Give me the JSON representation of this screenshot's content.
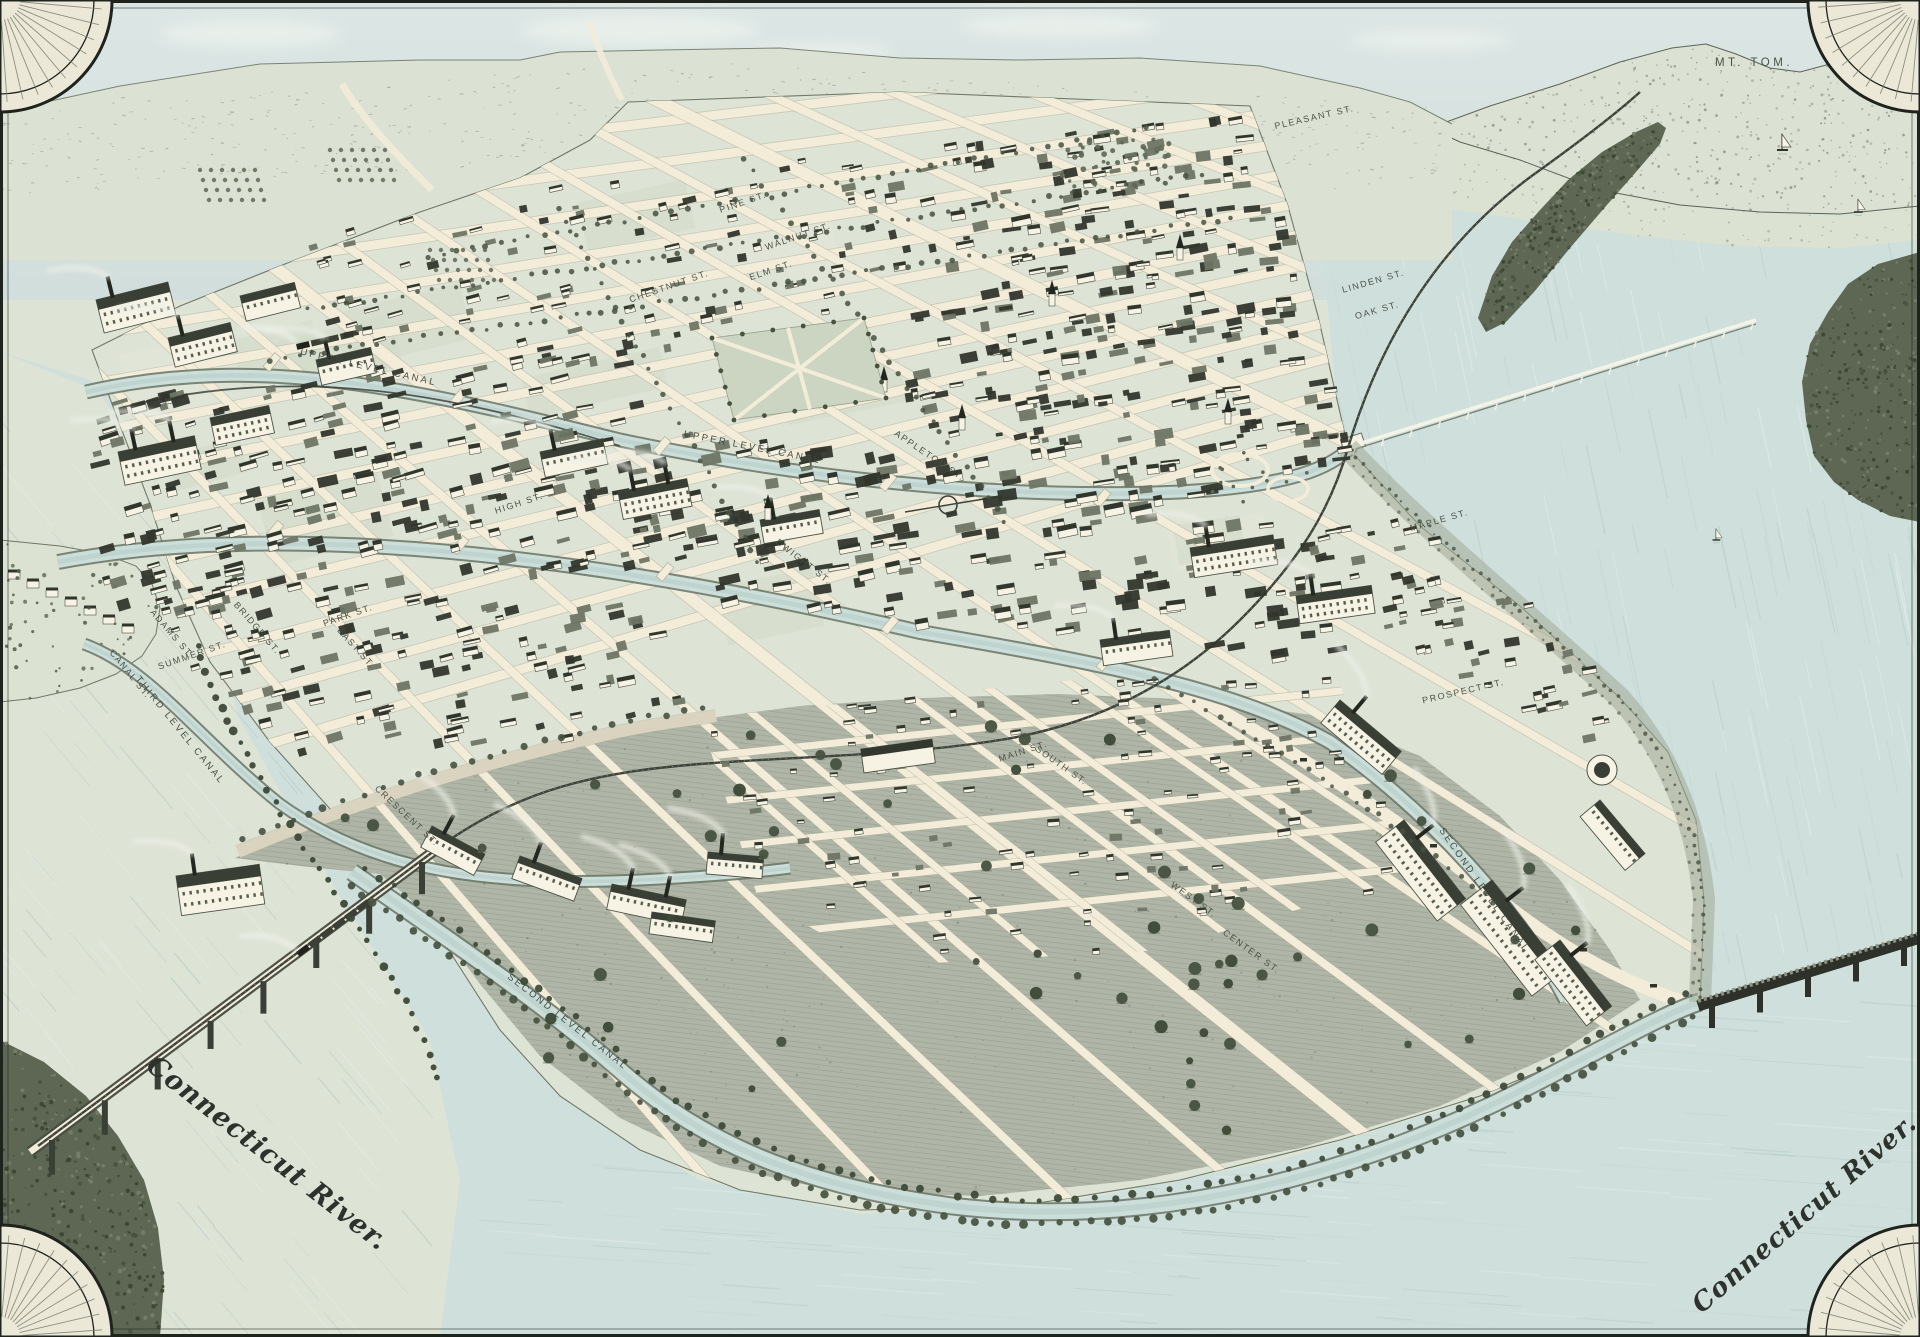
{
  "meta": {
    "title": "Bird's-eye view map of a Connecticut River mill city"
  },
  "colors": {
    "sky": "#d6e1df",
    "cloud": "#f3f6f1",
    "hills": "#dce2d3",
    "hill_texture": "#87907e",
    "fields": "#dce2d2",
    "water": "#cfdfdc",
    "water_streak": "#b4cac6",
    "water_light": "#e4eeec",
    "land": "#dde3d5",
    "block_tint_a": "#d2dac8",
    "block_tint_b": "#e3e8da",
    "meadow": "#b0b6a7",
    "meadow_texture": "#868d7d",
    "street": "#f2ecd9",
    "street_edge": "#b4af9c",
    "woods_dark": "#46513f",
    "woods_mid": "#5d6754",
    "woods_light": "#76806a",
    "canal_water": "#cbdeda",
    "canal_edge": "#6f7a6b",
    "rail": "#3d433b",
    "bluff": "#a2aa96",
    "building_dark": "#31362d",
    "building_mid": "#6e7565",
    "building_light": "#f6f3e5",
    "building_line": "#4c5246",
    "smoke": "#edefe8",
    "ink": "#434841",
    "frame": "#1f231d",
    "corner_paper": "#ece8d8"
  },
  "map_labels": [
    {
      "t": "SUMMER ST.",
      "x": 193,
      "y": 658,
      "r": -19,
      "c": "street"
    },
    {
      "t": "PARK ST.",
      "x": 349,
      "y": 618,
      "r": -19,
      "c": "street"
    },
    {
      "t": "HIGH ST.",
      "x": 520,
      "y": 506,
      "r": -18,
      "c": "street"
    },
    {
      "t": "MAIN ST.",
      "x": 1024,
      "y": 754,
      "r": -18,
      "c": "street"
    },
    {
      "t": "MAPLE ST.",
      "x": 1440,
      "y": 523,
      "r": -16,
      "c": "street"
    },
    {
      "t": "PROSPECT ST.",
      "x": 1464,
      "y": 694,
      "r": -13,
      "c": "street"
    },
    {
      "t": "WALNUT ST.",
      "x": 799,
      "y": 239,
      "r": -19,
      "c": "street"
    },
    {
      "t": "ELM ST.",
      "x": 772,
      "y": 273,
      "r": -19,
      "c": "street"
    },
    {
      "t": "PINE ST.",
      "x": 744,
      "y": 205,
      "r": -19,
      "c": "street"
    },
    {
      "t": "CHESTNUT ST.",
      "x": 670,
      "y": 289,
      "r": -19,
      "c": "street"
    },
    {
      "t": "LINDEN ST.",
      "x": 1374,
      "y": 284,
      "r": -16,
      "c": "street"
    },
    {
      "t": "OAK ST.",
      "x": 1378,
      "y": 313,
      "r": -16,
      "c": "street"
    },
    {
      "t": "PLEASANT ST.",
      "x": 1315,
      "y": 120,
      "r": -13,
      "c": "street"
    },
    {
      "t": "BRIDGE ST.",
      "x": 255,
      "y": 630,
      "r": 49,
      "c": "street"
    },
    {
      "t": "EAST ST.",
      "x": 354,
      "y": 650,
      "r": 48,
      "c": "street"
    },
    {
      "t": "CANAL ST.",
      "x": 128,
      "y": 676,
      "r": 51,
      "c": "street"
    },
    {
      "t": "ADAMS ST.",
      "x": 170,
      "y": 636,
      "r": 49,
      "c": "street"
    },
    {
      "t": "CRESCENT ST.",
      "x": 405,
      "y": 818,
      "r": 43,
      "c": "street"
    },
    {
      "t": "APPLETON ST.",
      "x": 928,
      "y": 458,
      "r": 34,
      "c": "street"
    },
    {
      "t": "DWIGHT ST.",
      "x": 802,
      "y": 564,
      "r": 38,
      "c": "street"
    },
    {
      "t": "SOUTH ST.",
      "x": 1060,
      "y": 768,
      "r": 35,
      "c": "street"
    },
    {
      "t": "WEST ST.",
      "x": 1192,
      "y": 902,
      "r": 36,
      "c": "street"
    },
    {
      "t": "CENTER ST.",
      "x": 1250,
      "y": 954,
      "r": 36,
      "c": "street"
    },
    {
      "t": "UPPER LEVEL CANAL",
      "x": 368,
      "y": 370,
      "r": 13,
      "c": "canal"
    },
    {
      "t": "UPPER LEVEL CANAL",
      "x": 752,
      "y": 450,
      "r": 11,
      "c": "canal"
    },
    {
      "t": "SECOND LEVEL CANAL",
      "x": 566,
      "y": 1024,
      "r": 38,
      "c": "canal"
    },
    {
      "t": "SECOND LEVEL CANAL",
      "x": 1482,
      "y": 892,
      "r": 55,
      "c": "canal"
    },
    {
      "t": "THIRD LEVEL CANAL",
      "x": 178,
      "y": 732,
      "r": 51,
      "c": "canal"
    },
    {
      "t": "MT. TOM.",
      "x": 1754,
      "y": 66,
      "r": 0,
      "c": "peak"
    },
    {
      "t": "Connecticut River.",
      "x": 262,
      "y": 1160,
      "r": 38,
      "c": "script",
      "s": 27
    },
    {
      "t": "Connecticut River.",
      "x": 1810,
      "y": 1220,
      "r": -41,
      "c": "script",
      "s": 26
    }
  ],
  "artwork": {
    "seed": 7,
    "speckle_density": 1,
    "building_density": 1,
    "tree_density": 1,
    "boats": [
      {
        "x": 1782,
        "y": 150,
        "s": 1.0
      },
      {
        "x": 1858,
        "y": 212,
        "s": 0.8
      },
      {
        "x": 1716,
        "y": 540,
        "s": 0.7
      }
    ]
  }
}
